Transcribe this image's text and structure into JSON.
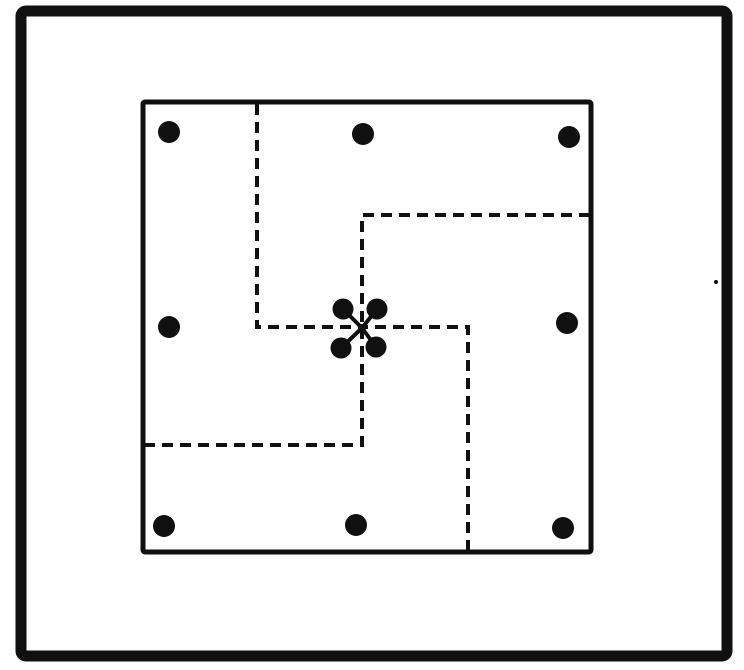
{
  "figure": {
    "kind": "vintage-puzzle-plate",
    "description_of_pixels": "square plot framed by thick outer border; inner square with eight black dots on its margin, a four-dot cluster at the center, and dashed pinwheel lines dividing the inner square into four congruent pieces",
    "canvas": {
      "width": 744,
      "height": 670
    },
    "colors": {
      "ink": "#101010",
      "paper": "#ffffff"
    },
    "outer_border": {
      "x": 21,
      "y": 11,
      "width": 706,
      "height": 645,
      "stroke_width": 11,
      "corner_radius": 5
    },
    "inner_square": {
      "x": 143,
      "y": 102,
      "width": 448,
      "height": 450,
      "stroke_width": 5,
      "corner_radius": 2
    },
    "dash_style": {
      "stroke_width": 4,
      "dash_array": "11 7"
    },
    "dashed_arms": [
      {
        "name": "from-top-edge",
        "points": [
          [
            257,
            104
          ],
          [
            257,
            327
          ],
          [
            361,
            327
          ]
        ]
      },
      {
        "name": "from-right-edge",
        "points": [
          [
            590,
            215
          ],
          [
            362,
            215
          ],
          [
            362,
            328
          ]
        ]
      },
      {
        "name": "from-bottom-edge",
        "points": [
          [
            468,
            551
          ],
          [
            468,
            327
          ],
          [
            361,
            327
          ]
        ]
      },
      {
        "name": "from-left-edge",
        "points": [
          [
            144,
            445
          ],
          [
            362,
            445
          ],
          [
            362,
            328
          ]
        ]
      }
    ],
    "perimeter_dots": {
      "radius": 11,
      "points": [
        {
          "name": "top-left",
          "cx": 169,
          "cy": 132
        },
        {
          "name": "top-center",
          "cx": 363,
          "cy": 134
        },
        {
          "name": "top-right",
          "cx": 569,
          "cy": 137
        },
        {
          "name": "middle-left",
          "cx": 169,
          "cy": 327
        },
        {
          "name": "middle-right",
          "cx": 567,
          "cy": 323
        },
        {
          "name": "bottom-left",
          "cx": 164,
          "cy": 526
        },
        {
          "name": "bottom-center",
          "cx": 356,
          "cy": 525
        },
        {
          "name": "bottom-right",
          "cx": 563,
          "cy": 528
        }
      ]
    },
    "center_cluster": {
      "center": {
        "cx": 362,
        "cy": 328
      },
      "stem_stroke_width": 4,
      "knot_radius": 4,
      "dot_radius": 10.5,
      "dots": [
        {
          "name": "northwest",
          "cx": 343,
          "cy": 309
        },
        {
          "name": "northeast",
          "cx": 377,
          "cy": 309
        },
        {
          "name": "southwest",
          "cx": 341,
          "cy": 348
        },
        {
          "name": "southeast",
          "cx": 376,
          "cy": 347
        }
      ]
    },
    "ink_speck": {
      "cx": 716,
      "cy": 282,
      "radius": 2
    }
  }
}
